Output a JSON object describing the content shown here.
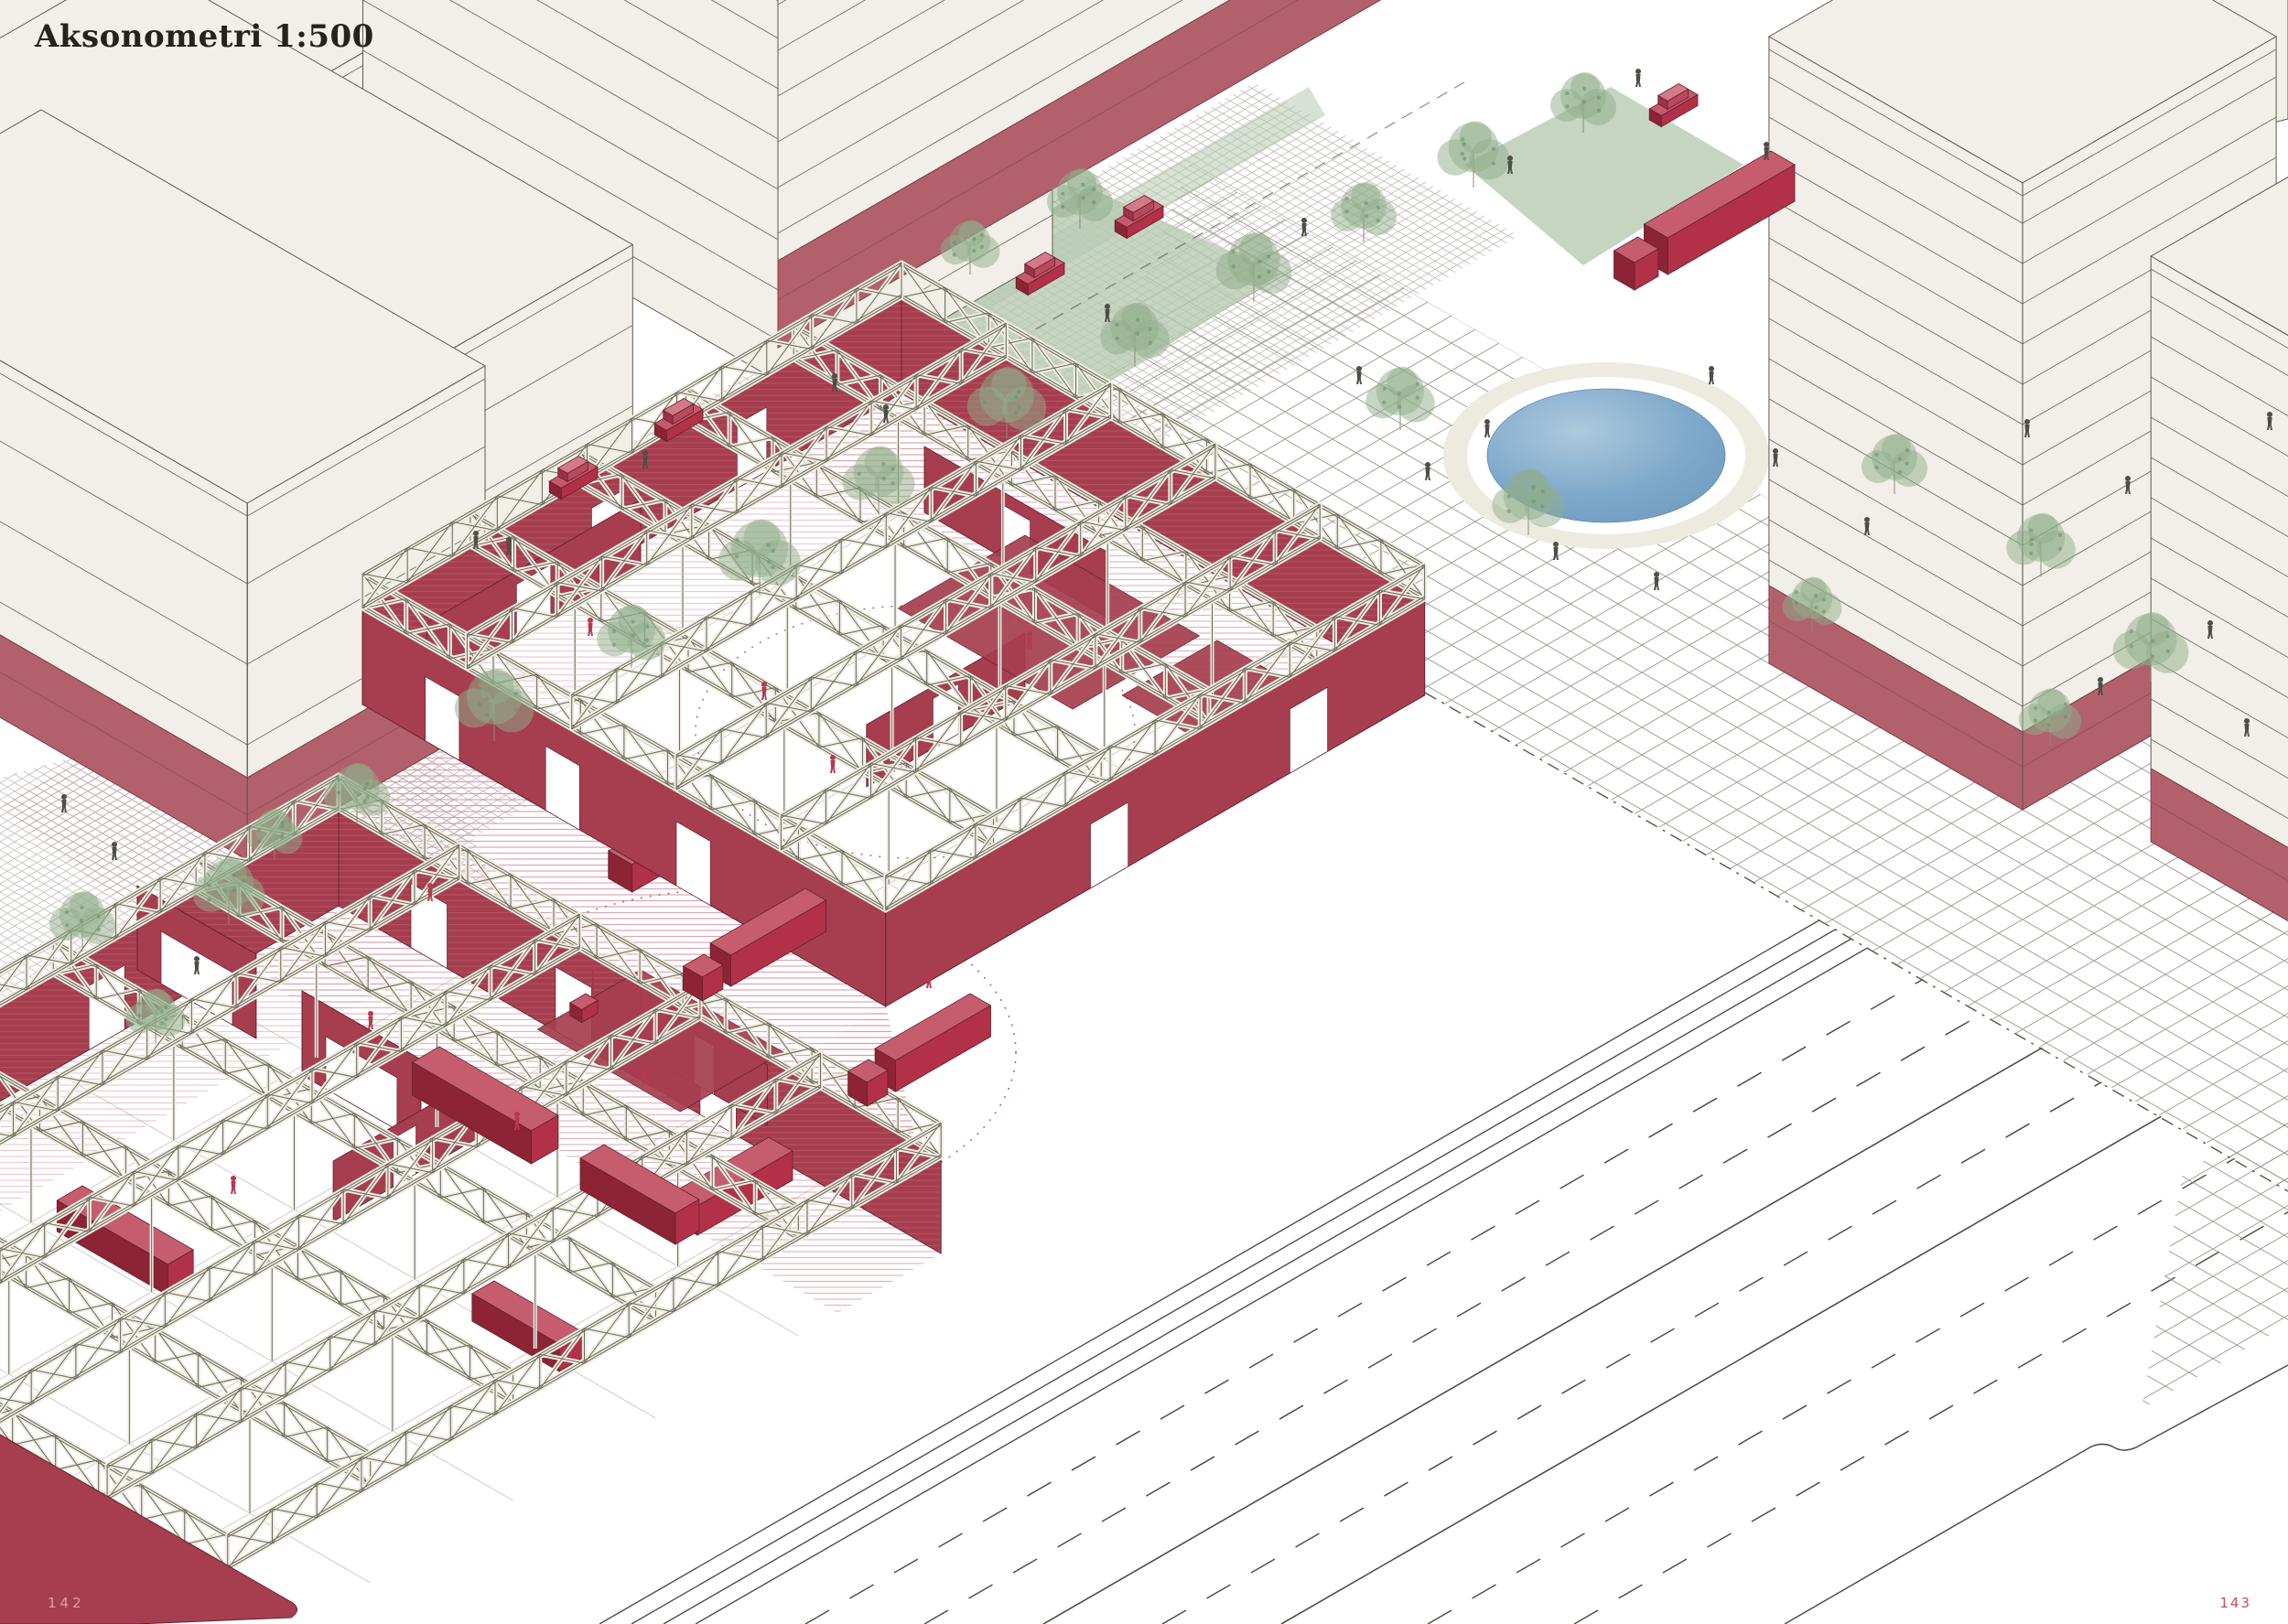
{
  "title": "Aksonometri 1:500",
  "pages": {
    "left": "142",
    "right": "143"
  },
  "palette": {
    "paper": "#ffffff",
    "cream": "#f1efe7",
    "outline": "#5c5c52",
    "stripe": "#6e6e63",
    "wallRed": "#a63e4f",
    "wallEdge": "#64222e",
    "baseBand": "#b2616c",
    "bandEdge": "#7e3c46",
    "accentRed": "#b23148",
    "accentRedDark": "#8c2435",
    "accentRedTop": "#c65d6e",
    "hatchRed": "#d795a0",
    "pavementHatch": "#bfacac",
    "plazaGrid": "#9a9a8f",
    "floorGrid": "#c9c9bf",
    "foliage": "#8fae8a",
    "foliageDark": "#6f9070",
    "lawn": "#b6cab0",
    "pondDeep": "#6f9cc1",
    "pondMid": "#7fa9ca",
    "pondLight": "#aec9dd",
    "pondWalk": "#edebe0",
    "figure": "#4e4e47",
    "figureRed": "#b5394e",
    "roadLine": "#4f4f47",
    "trussFill": "#f1ede1",
    "trussLine": "#6b6b60",
    "dash": "#55554c",
    "pageLeftNum": "#d8a3ab",
    "pageRightNum": "#c24f5f",
    "titleInk": "#24231e"
  }
}
